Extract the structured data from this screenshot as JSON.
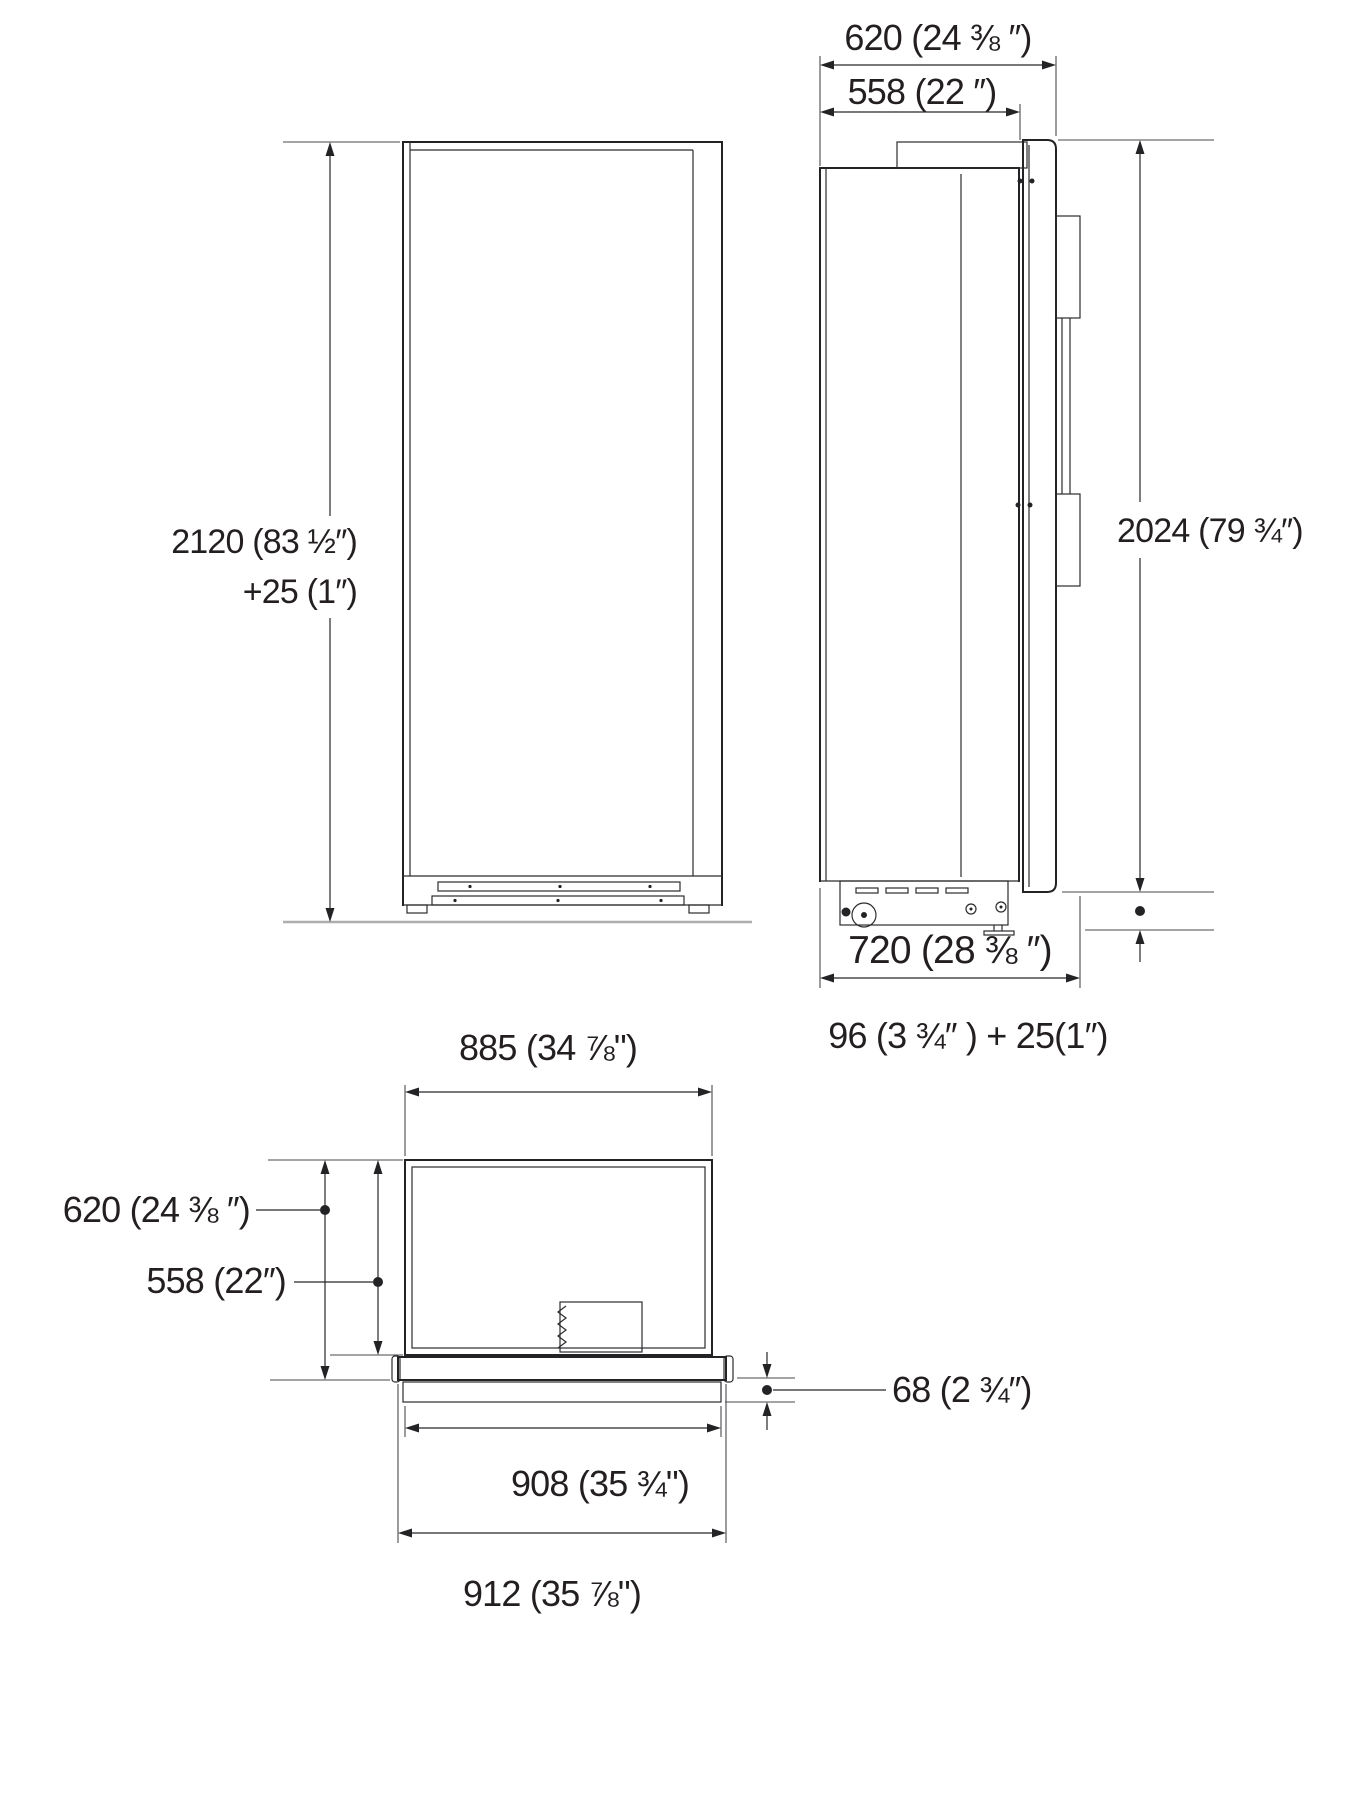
{
  "colors": {
    "line": "#232325",
    "dimension_line": "#28282b",
    "text": "#231f20",
    "floor_line": "#aeaeae",
    "background": "#ffffff"
  },
  "views": {
    "front": {
      "labels": {
        "height": "2120 (83 ½″)",
        "height_adjust": "+25 (1″)"
      }
    },
    "side": {
      "labels": {
        "depth_top": "620 (24 ⅜ ″)",
        "depth_recess": "558 (22 ″)",
        "door_height": "2024 (79 ¾″)",
        "depth_total": "720 (28 ⅜ ″)",
        "base_height": "96 (3 ¾″ ) + 25(1″)"
      }
    },
    "top": {
      "labels": {
        "width": "885  (34 ⅞\")",
        "depth_incl_door": "620 (24 ⅜ ″)",
        "depth_body": "558 (22″)",
        "door_offset": "68 (2 ¾″)",
        "door_width": "908  (35 ¾\")",
        "total_width": "912  (35 ⅞\")"
      }
    }
  }
}
